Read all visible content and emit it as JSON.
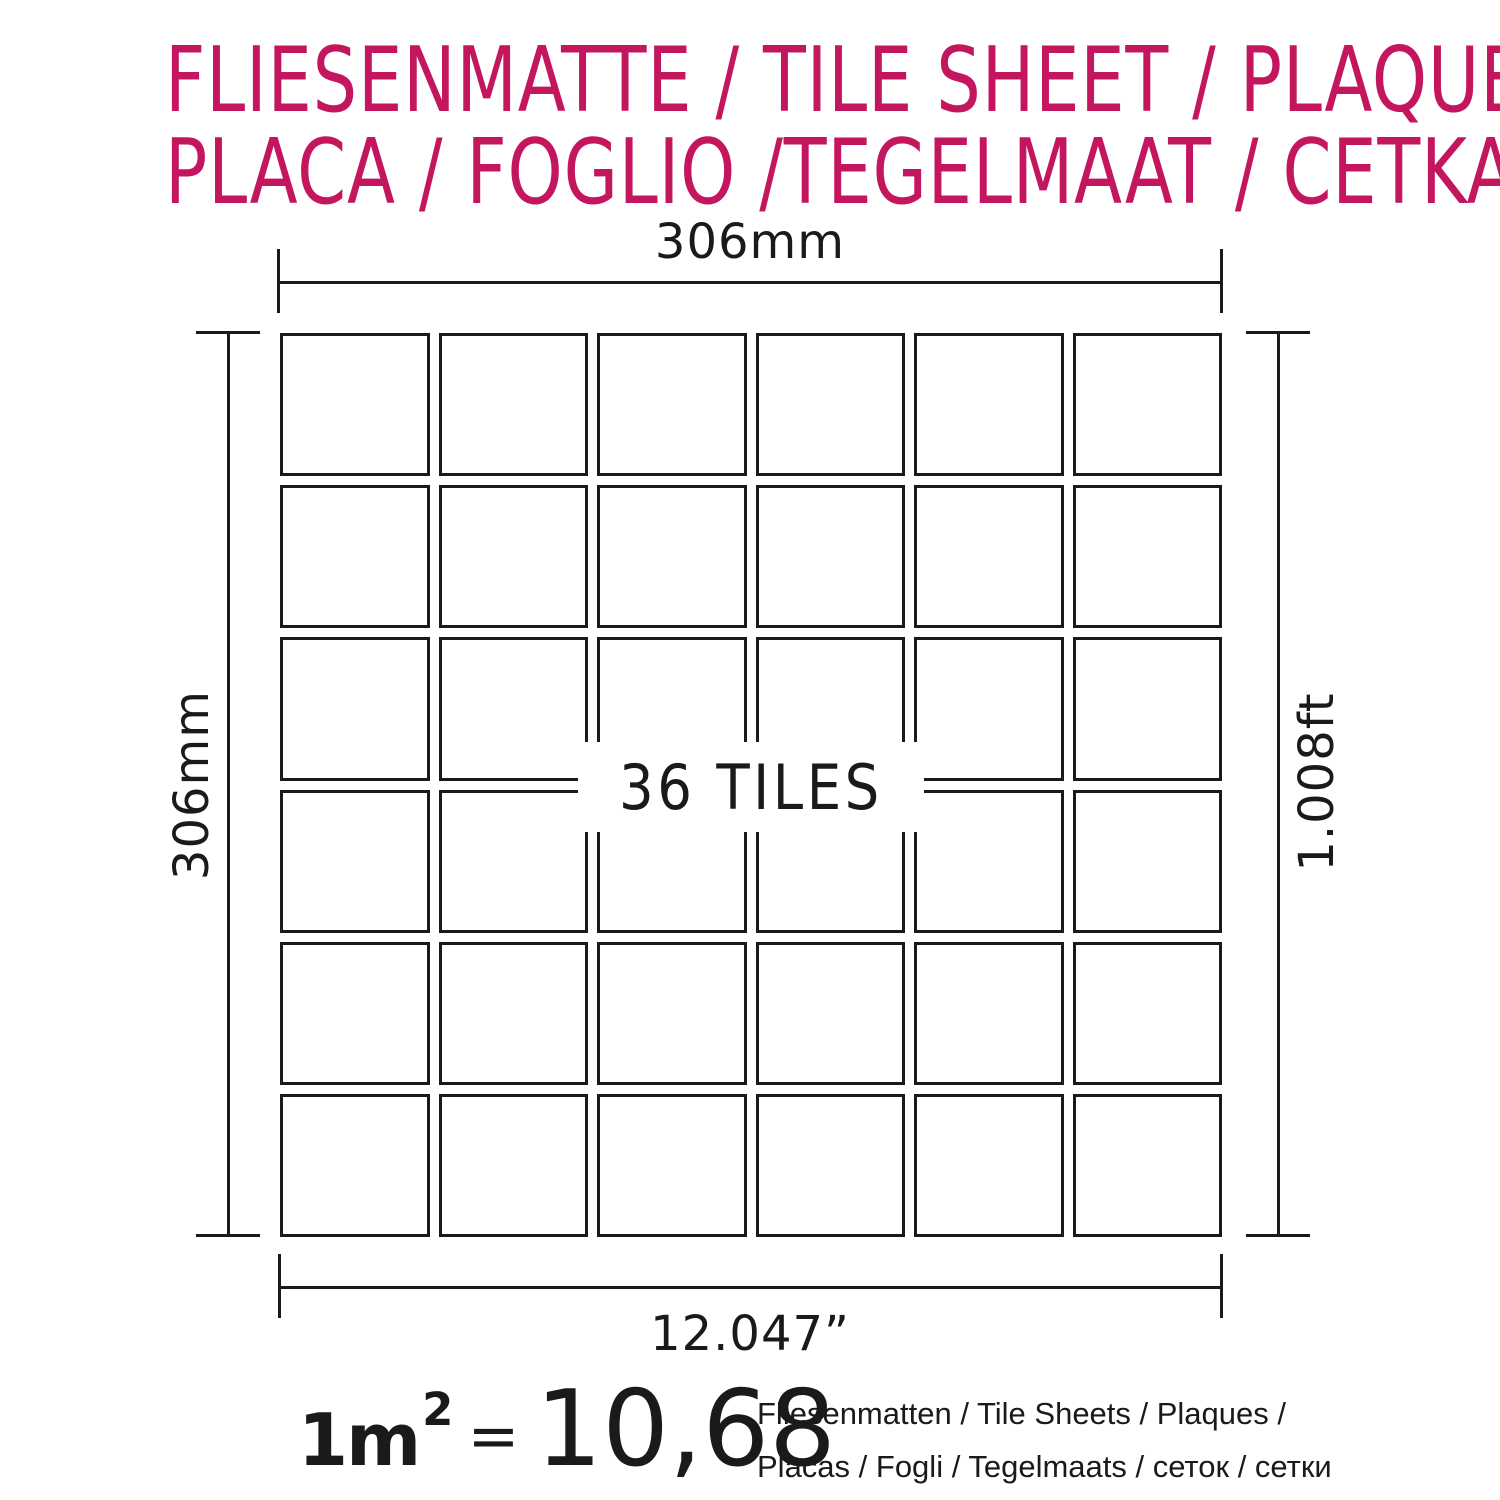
{
  "title": {
    "line1": "FLIESENMATTE / TILE SHEET / PLAQUE",
    "line2": "PLACA / FOGLIO /TEGELMAAT / CETKA",
    "color": "#C4155F"
  },
  "diagram": {
    "grid": {
      "rows": 6,
      "cols": 6,
      "tile_count": 36
    },
    "tiles_label": "36 TILES",
    "dimensions": {
      "top": "306mm",
      "left": "306mm",
      "right": "1.008ft",
      "bottom": "12.047”"
    },
    "line_color": "#1a1a1a"
  },
  "formula": {
    "lhs": "1m",
    "exponent": "2",
    "equals": "=",
    "value": "10,68",
    "units_line1": "Fliesenmatten / Tile Sheets /  Plaques /",
    "units_line2": "Placas / Fogli / Tegelmaats / сеток / сетки"
  }
}
